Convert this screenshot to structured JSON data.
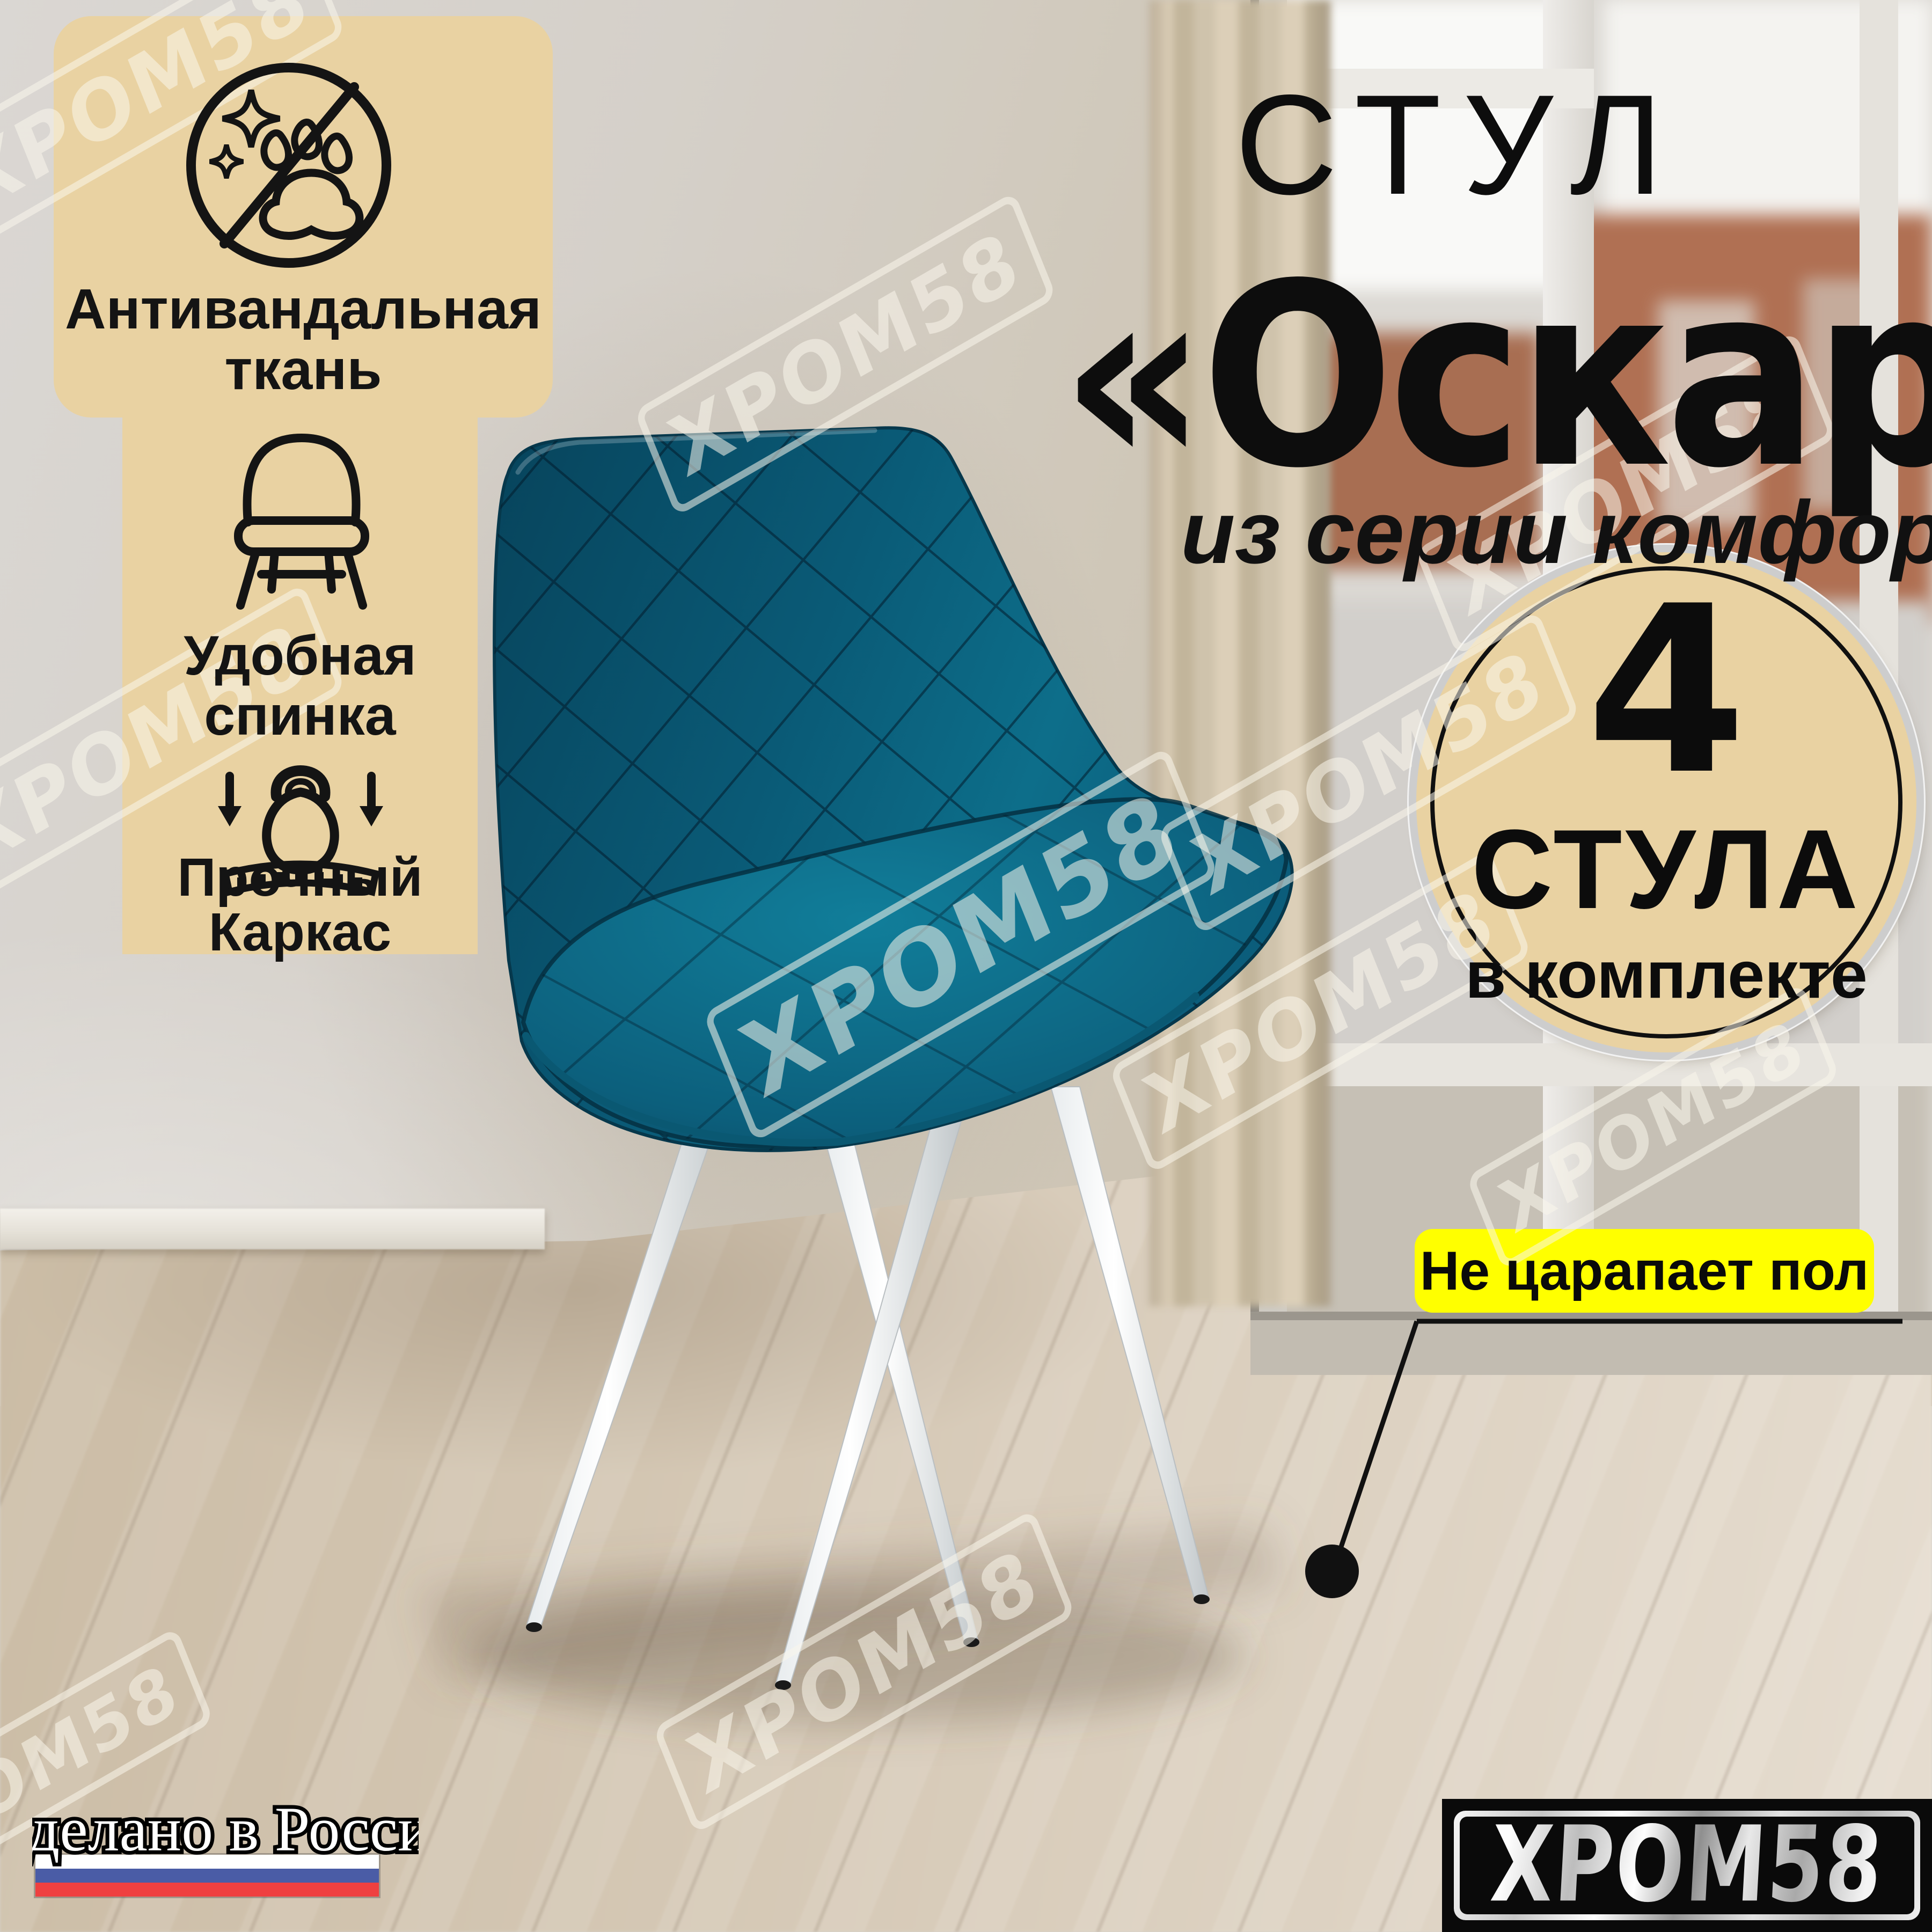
{
  "watermark": {
    "text": "ХРОМ58"
  },
  "header": {
    "kicker": "СТУЛ",
    "name": "«Оскар»",
    "series": "из серии комфорт"
  },
  "features": [
    {
      "line1": "Антивандальная",
      "line2": "ткань",
      "icon": "anti-vandal-icon"
    },
    {
      "line1": "Удобная",
      "line2": "спинка",
      "icon": "chair-icon"
    },
    {
      "line1": "Прочный",
      "line2": "Каркас",
      "icon": "kettlebell-icon"
    }
  ],
  "bundle": {
    "count": "4",
    "unit": "СТУЛА",
    "note": "в комплекте"
  },
  "callout": {
    "label": "Не царапает пол"
  },
  "origin": {
    "label": "Сделано в России",
    "flag": "russian-flag-icon"
  },
  "brand": {
    "logo": "ХРОМ58"
  },
  "colors": {
    "panel_beige": "#e9d2a2",
    "callout_yellow": "#ffff00",
    "chair_teal": "#0d6a86",
    "legs_white": "#eef1f2",
    "flag_blue": "#4a5ca6",
    "flag_red": "#ef4040",
    "text_black": "#0d0d0d"
  }
}
